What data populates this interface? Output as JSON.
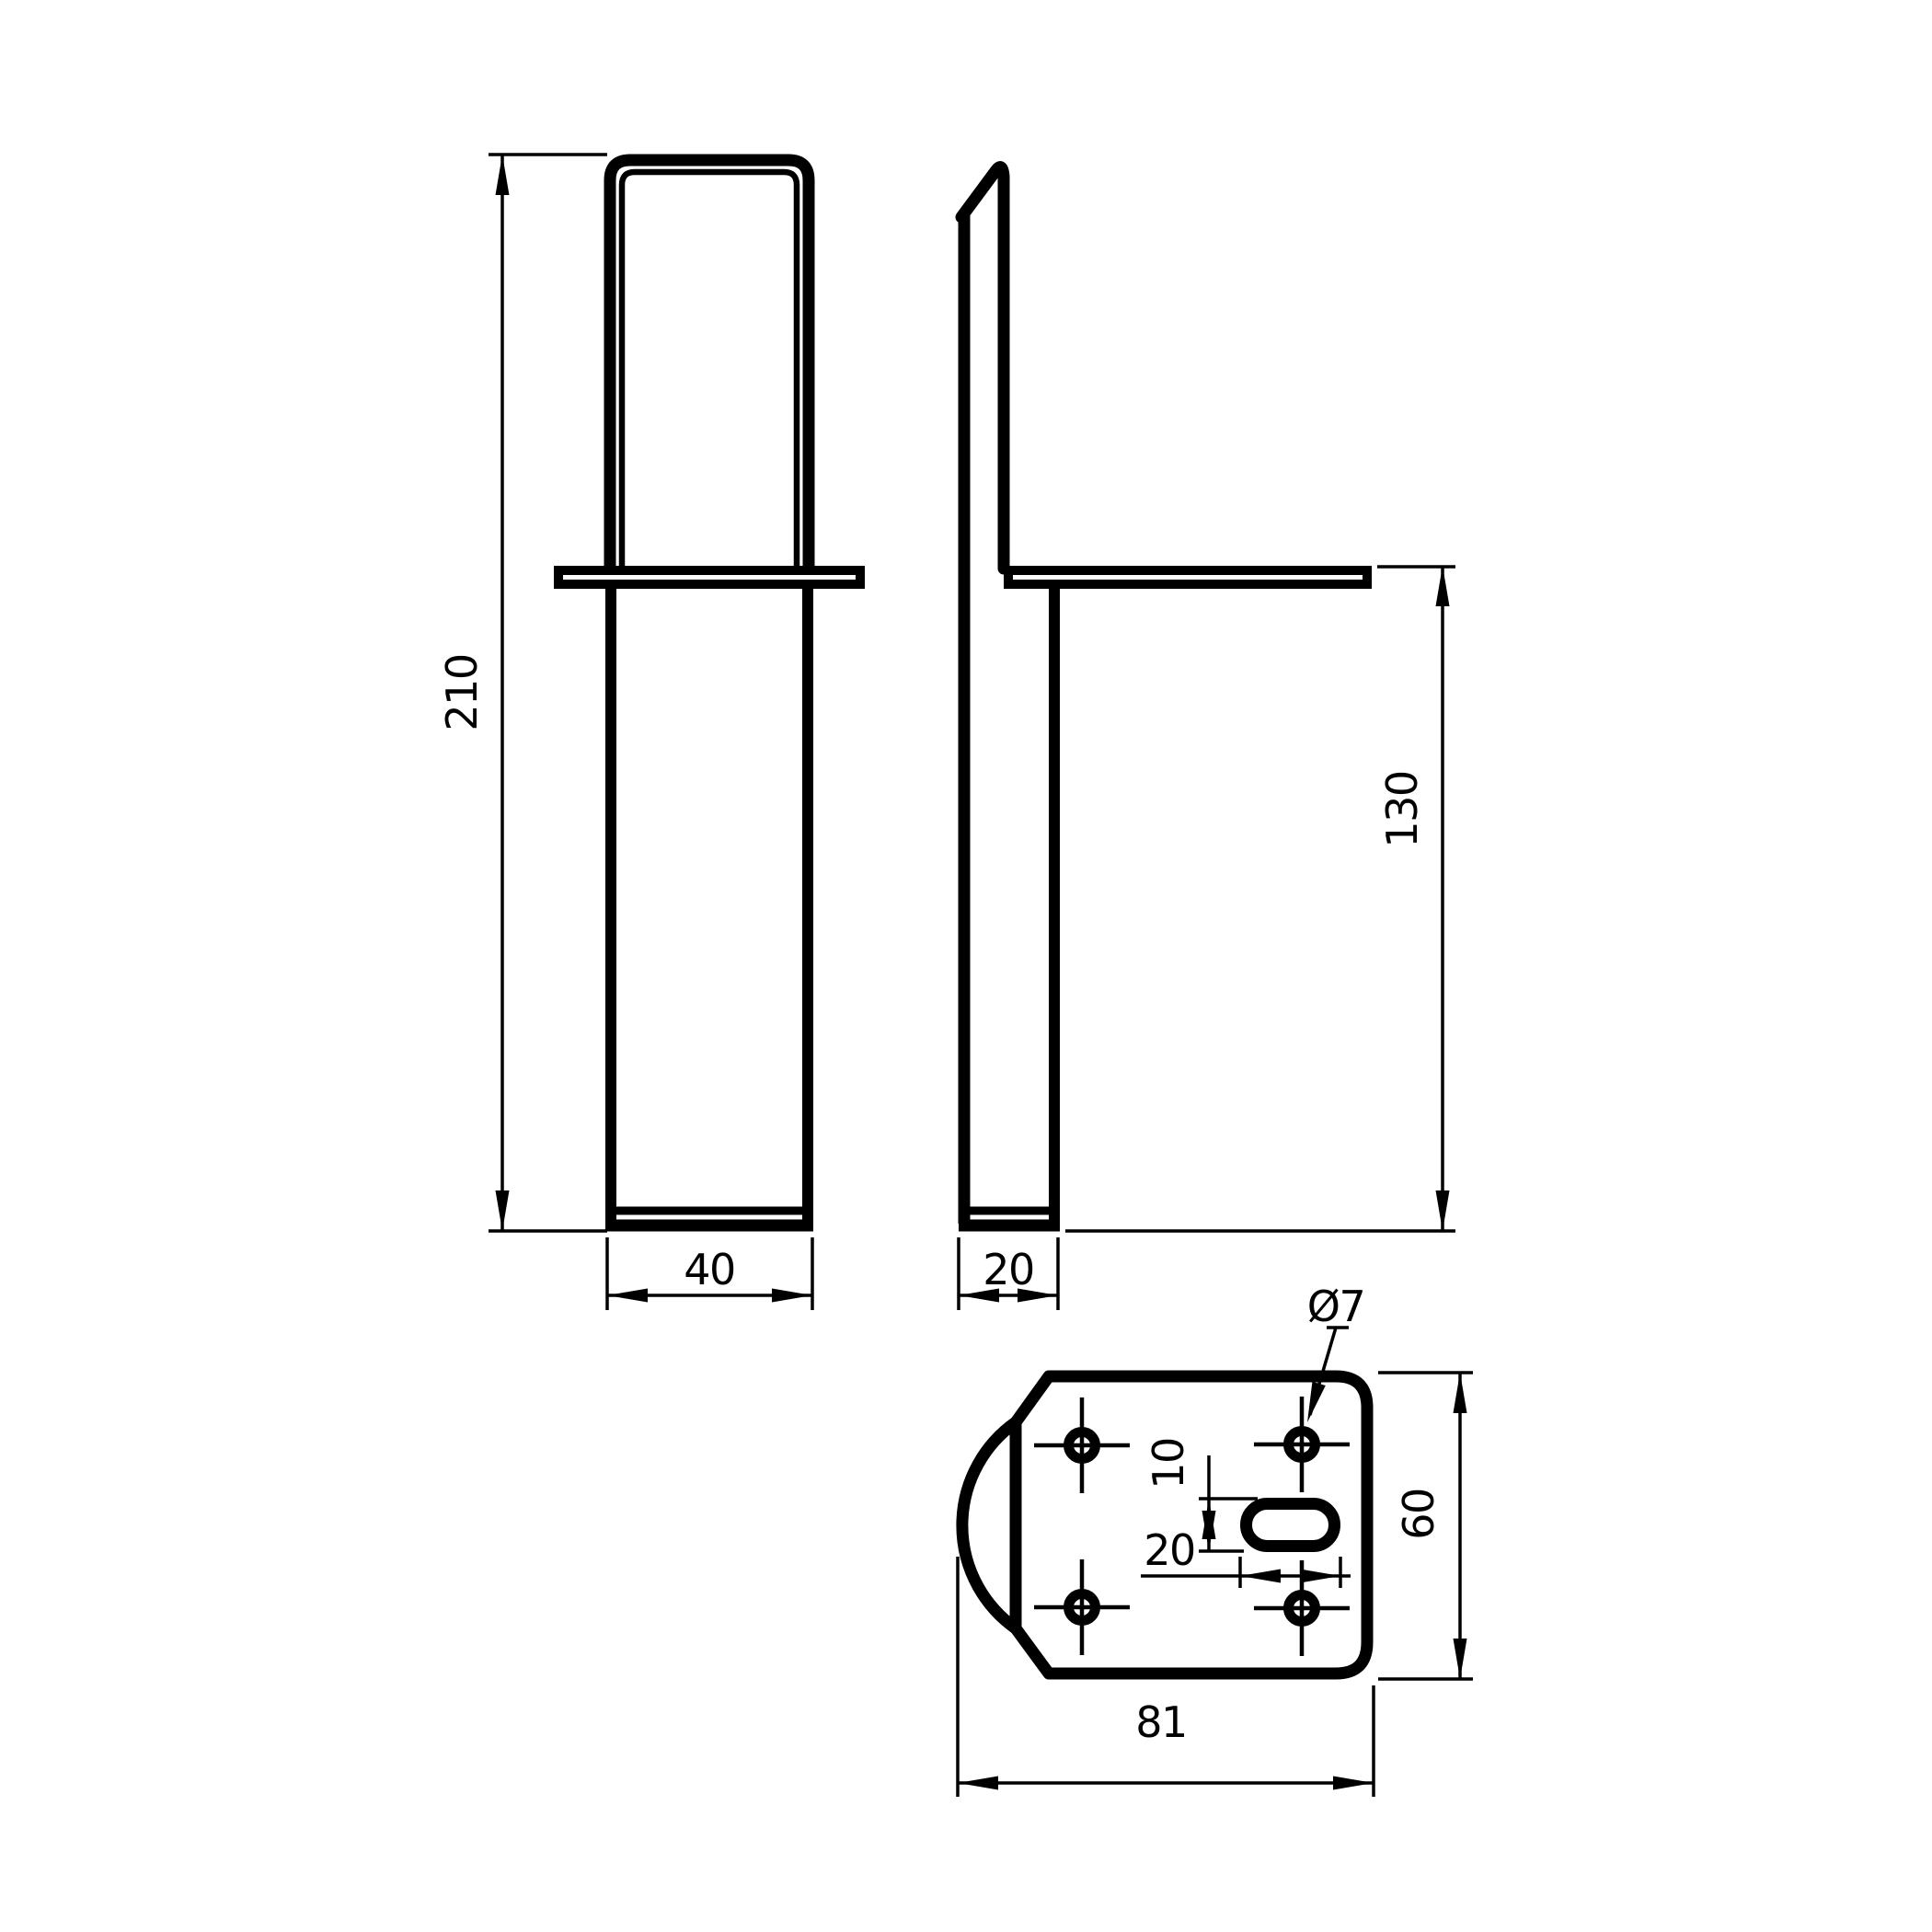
{
  "drawing": {
    "type": "technical-drawing",
    "subject": "furniture leg with mounting bracket plate",
    "background_color": "#ffffff",
    "line_color": "#000000",
    "dims": {
      "front_total_height": "210",
      "front_leg_width": "40",
      "side_leg_depth": "20",
      "side_mount_height": "130",
      "hole_diameter": "Ø7",
      "slot_width": "10",
      "slot_length": "20",
      "plate_width": "60",
      "plate_length": "81"
    }
  }
}
